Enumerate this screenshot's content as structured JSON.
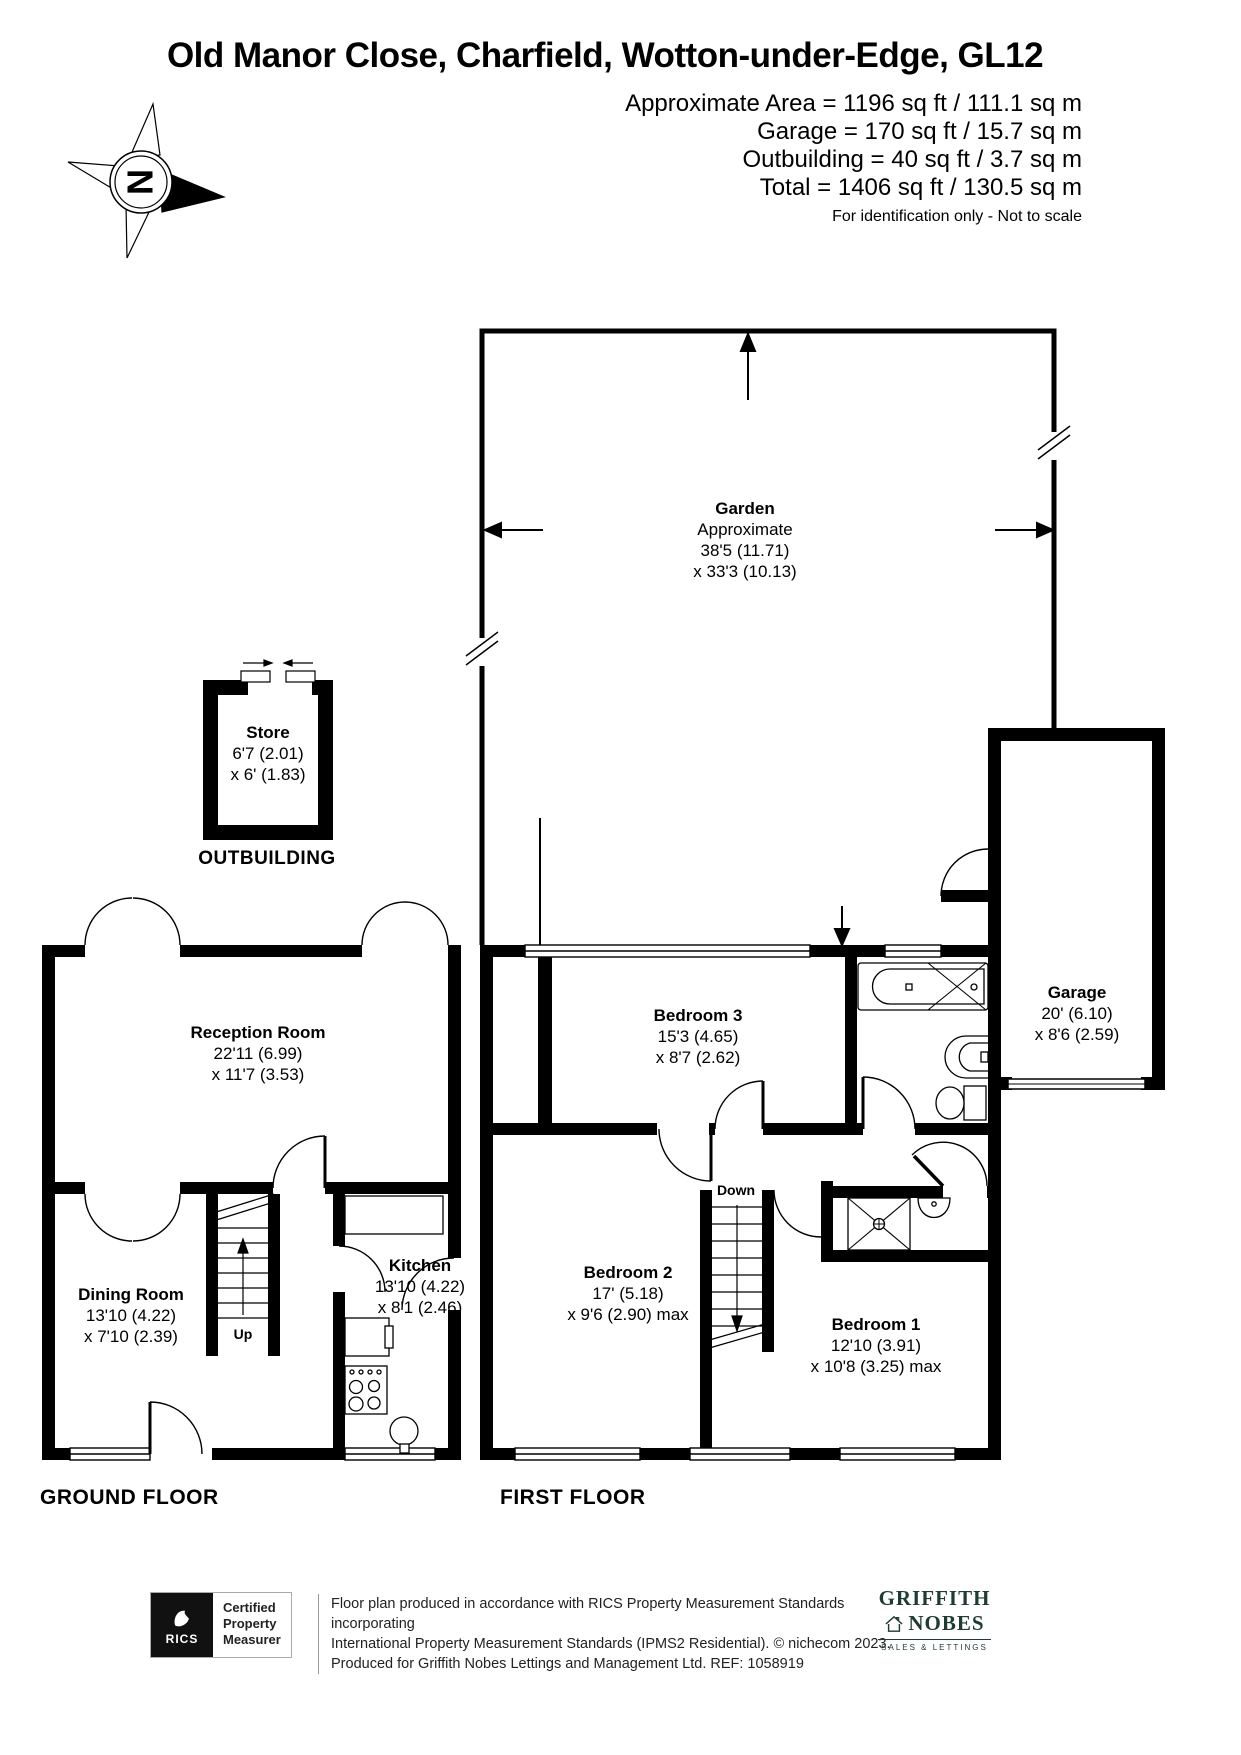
{
  "header": {
    "title": "Old Manor Close, Charfield, Wotton-under-Edge, GL12",
    "area_lines": [
      "Approximate Area = 1196 sq ft / 111.1 sq m",
      "Garage = 170 sq ft / 15.7 sq m",
      "Outbuilding = 40 sq ft / 3.7 sq m",
      "Total = 1406 sq ft / 130.5 sq m"
    ],
    "disclaimer": "For identification only - Not to scale",
    "compass": "N"
  },
  "garden": {
    "name": "Garden",
    "approx": "Approximate",
    "dim1": "38'5 (11.71)",
    "dim2": "x 33'3 (10.13)"
  },
  "outbuilding": {
    "label": "OUTBUILDING",
    "store_name": "Store",
    "store_dim1": "6'7 (2.01)",
    "store_dim2": "x 6' (1.83)"
  },
  "ground_floor": {
    "label": "GROUND FLOOR",
    "stairs": "Up",
    "reception": {
      "name": "Reception Room",
      "dim1": "22'11 (6.99)",
      "dim2": "x 11'7 (3.53)"
    },
    "dining": {
      "name": "Dining Room",
      "dim1": "13'10 (4.22)",
      "dim2": "x 7'10 (2.39)"
    },
    "kitchen": {
      "name": "Kitchen",
      "dim1": "13'10 (4.22)",
      "dim2": "x 8'1 (2.46)"
    }
  },
  "first_floor": {
    "label": "FIRST FLOOR",
    "stairs": "Down",
    "bedroom1": {
      "name": "Bedroom 1",
      "dim1": "12'10 (3.91)",
      "dim2": "x 10'8 (3.25) max"
    },
    "bedroom2": {
      "name": "Bedroom 2",
      "dim1": "17' (5.18)",
      "dim2": "x 9'6 (2.90) max"
    },
    "bedroom3": {
      "name": "Bedroom 3",
      "dim1": "15'3 (4.65)",
      "dim2": "x 8'7 (2.62)"
    },
    "garage": {
      "name": "Garage",
      "dim1": "20' (6.10)",
      "dim2": "x 8'6 (2.59)"
    }
  },
  "footer": {
    "rics": "RICS",
    "badge_lines": [
      "Certified",
      "Property",
      "Measurer"
    ],
    "lines": [
      "Floor plan produced in accordance with RICS Property Measurement Standards incorporating",
      "International Property Measurement Standards (IPMS2 Residential).   © nichecom 2023.",
      "Produced for Griffith Nobes Lettings and Management Ltd.   REF: 1058919"
    ],
    "agency_top": "GRIFFITH",
    "agency_bottom": "NOBES",
    "agency_tagline": "SALES & LETTINGS"
  }
}
